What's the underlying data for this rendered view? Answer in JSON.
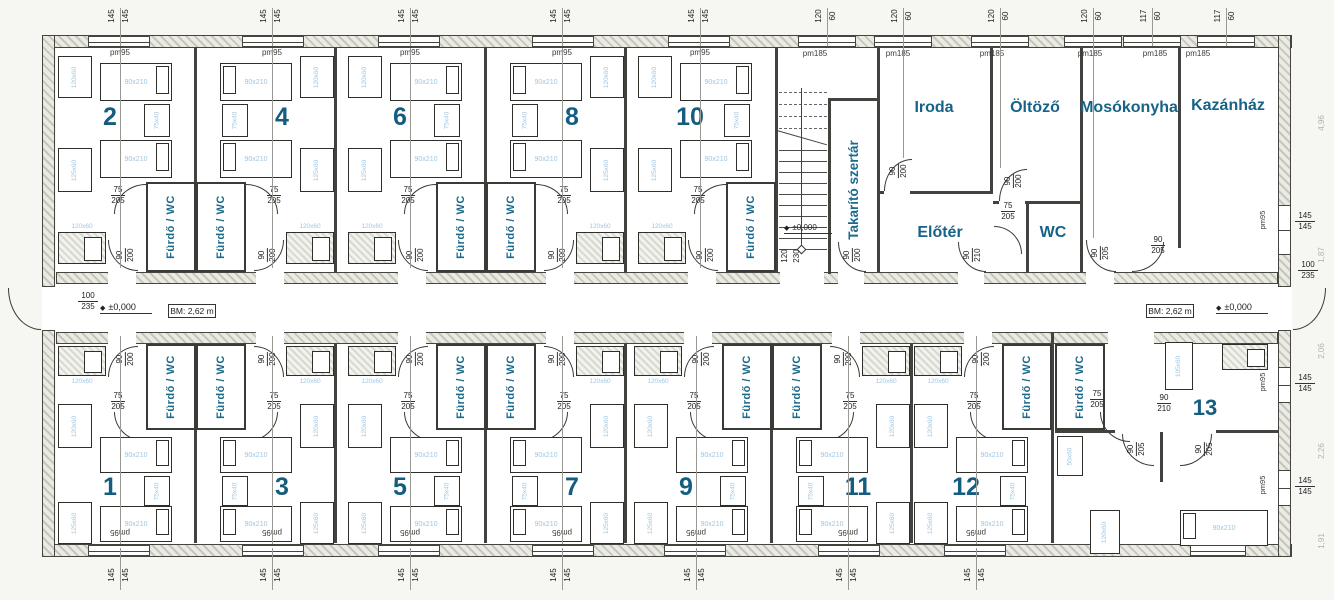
{
  "header": {
    "floor_label": "Földszint",
    "corridor_label": "Közlekedő"
  },
  "marks": {
    "level": "±0,000",
    "bm": "BM: 2,62 m"
  },
  "labels": {
    "bath": "Fürdő / WC",
    "pm95": "pm95",
    "pm185": "pm185"
  },
  "rooms": {
    "top": [
      "2",
      "4",
      "6",
      "8",
      "10"
    ],
    "bottom": [
      "1",
      "3",
      "5",
      "7",
      "9",
      "11",
      "12",
      "13"
    ]
  },
  "service": {
    "cleaning": "Takarító szertár",
    "office": "Iroda",
    "dressing": "Öltöző",
    "laundry": "Mosókonyha",
    "boiler": "Kazánház",
    "foyer": "Előtér",
    "wc": "WC"
  },
  "furniture": {
    "bed": "90x210",
    "nightstand": "75x40",
    "wardrobe": "120x60",
    "wardrobe_sm": "105x60",
    "wardrobe_lg": "125x60",
    "wardrobe_xs": "50x60",
    "counter": "120x60"
  },
  "dims": {
    "win_guest": [
      "145",
      "145"
    ],
    "win_service": [
      "120",
      "60"
    ],
    "win_boiler": [
      "117",
      "60"
    ],
    "door_bath": [
      "75",
      "205"
    ],
    "door_entry": [
      "90",
      "200"
    ],
    "door_interior": [
      "90",
      "205"
    ],
    "door_foyer": [
      "90",
      "210"
    ],
    "door_main": [
      "100",
      "235"
    ],
    "door_stairs": [
      "120",
      "230"
    ],
    "edge": [
      "4,96",
      "1,87",
      "2,06",
      "2,26",
      "1,91"
    ]
  },
  "colors": {
    "accent_purple": "#9b3fa3",
    "label_teal": "#176387",
    "bed_label_blue": "#9fc6e2"
  }
}
